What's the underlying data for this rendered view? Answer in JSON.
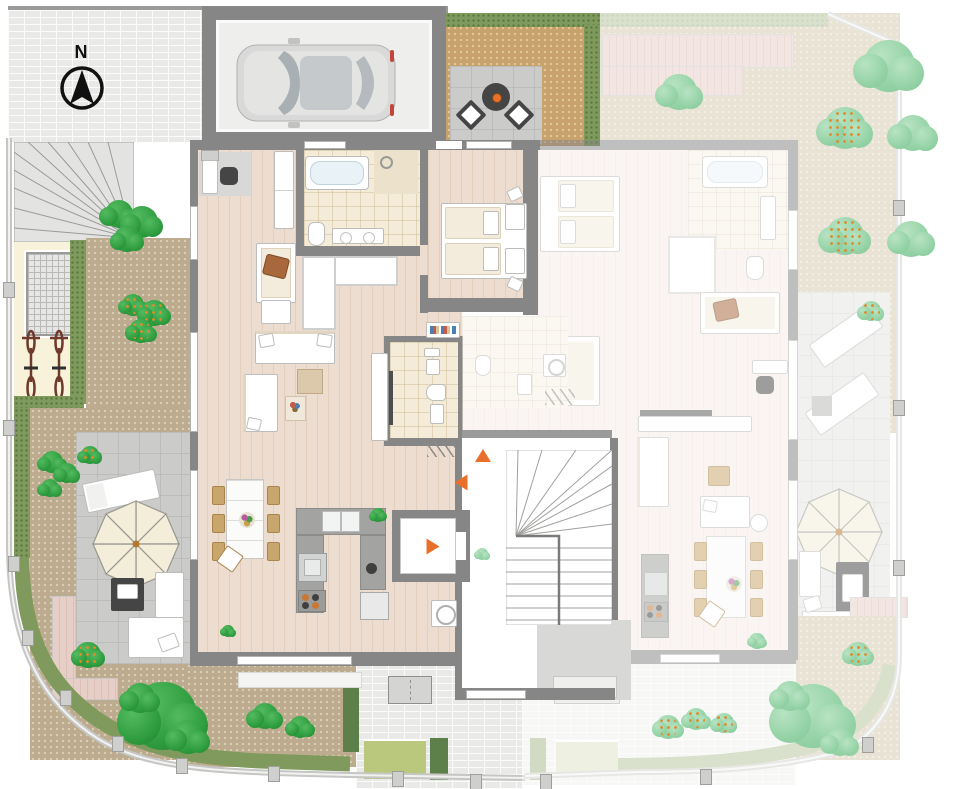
{
  "compass": {
    "label": "N"
  },
  "units": {
    "left": {
      "id": "apartment-left",
      "status": "highlighted"
    },
    "right": {
      "id": "apartment-right",
      "status": "dimmed"
    }
  },
  "palette": {
    "wall": "#868686",
    "wood": "#ecddd0",
    "wood_faded": "#f6ede7",
    "tile": "#f4ecd9",
    "terrace": "#cbcbc9",
    "brick": "#e9e9e7",
    "dirt_warm": "#c7a26c",
    "dirt_cool": "#bcab8e",
    "dirt_faded": "#d4cbb0",
    "hedge": "#7f9a5c",
    "hedge_faded": "#b7c49c",
    "lawn": "#b9c87d",
    "lawn_faded": "#e0e6c6",
    "tree": "#2f9e40",
    "tree_faded": "#95d3a6",
    "deck": "#e7cfc8",
    "umbrella": "#f3edd9",
    "accent_orange": "#e8702a",
    "car_body": "#d9d9d9"
  },
  "markers": {
    "entrance_arrows": [
      {
        "x": 483,
        "y": 456,
        "dir": "up"
      },
      {
        "x": 461,
        "y": 483,
        "dir": "left"
      },
      {
        "x": 433,
        "y": 547,
        "dir": "right"
      }
    ]
  },
  "vegetation": {
    "trees": [
      {
        "x": 119,
        "y": 214,
        "r": 17,
        "kind": "bright"
      },
      {
        "x": 142,
        "y": 222,
        "r": 19,
        "kind": "bright"
      },
      {
        "x": 127,
        "y": 239,
        "r": 15,
        "kind": "bright"
      },
      {
        "x": 133,
        "y": 305,
        "r": 13,
        "kind": "flower"
      },
      {
        "x": 154,
        "y": 313,
        "r": 15,
        "kind": "flower"
      },
      {
        "x": 141,
        "y": 331,
        "r": 14,
        "kind": "flower"
      },
      {
        "x": 52,
        "y": 462,
        "r": 13,
        "kind": "bright"
      },
      {
        "x": 67,
        "y": 473,
        "r": 12,
        "kind": "bright"
      },
      {
        "x": 50,
        "y": 488,
        "r": 11,
        "kind": "bright"
      },
      {
        "x": 90,
        "y": 455,
        "r": 11,
        "kind": "flower"
      },
      {
        "x": 88,
        "y": 655,
        "r": 15,
        "kind": "flower"
      },
      {
        "x": 163,
        "y": 716,
        "r": 40,
        "kind": "bright"
      },
      {
        "x": 140,
        "y": 698,
        "r": 18,
        "kind": "bright"
      },
      {
        "x": 188,
        "y": 737,
        "r": 20,
        "kind": "bright"
      },
      {
        "x": 265,
        "y": 716,
        "r": 16,
        "kind": "bright"
      },
      {
        "x": 300,
        "y": 727,
        "r": 13,
        "kind": "bright"
      },
      {
        "x": 228,
        "y": 631,
        "r": 7,
        "kind": "bright"
      },
      {
        "x": 378,
        "y": 515,
        "r": 8,
        "kind": "bright"
      },
      {
        "x": 679,
        "y": 92,
        "r": 21,
        "kind": "fade"
      },
      {
        "x": 889,
        "y": 66,
        "r": 31,
        "kind": "fade"
      },
      {
        "x": 845,
        "y": 128,
        "r": 25,
        "kind": "fadedflower"
      },
      {
        "x": 913,
        "y": 133,
        "r": 22,
        "kind": "fade"
      },
      {
        "x": 845,
        "y": 236,
        "r": 23,
        "kind": "fadedflower"
      },
      {
        "x": 911,
        "y": 239,
        "r": 21,
        "kind": "fade"
      },
      {
        "x": 871,
        "y": 311,
        "r": 12,
        "kind": "fadedflower"
      },
      {
        "x": 813,
        "y": 716,
        "r": 38,
        "kind": "fade"
      },
      {
        "x": 790,
        "y": 696,
        "r": 18,
        "kind": "fade"
      },
      {
        "x": 840,
        "y": 742,
        "r": 17,
        "kind": "fade"
      },
      {
        "x": 668,
        "y": 727,
        "r": 14,
        "kind": "fadedflower"
      },
      {
        "x": 696,
        "y": 719,
        "r": 13,
        "kind": "fadedflower"
      },
      {
        "x": 724,
        "y": 723,
        "r": 12,
        "kind": "fadedflower"
      },
      {
        "x": 858,
        "y": 654,
        "r": 14,
        "kind": "fadedflower"
      },
      {
        "x": 757,
        "y": 641,
        "r": 9,
        "kind": "fade"
      },
      {
        "x": 482,
        "y": 554,
        "r": 7,
        "kind": "fade"
      }
    ]
  },
  "fence_posts": [
    [
      3,
      282
    ],
    [
      3,
      420
    ],
    [
      8,
      556
    ],
    [
      22,
      630
    ],
    [
      60,
      690
    ],
    [
      112,
      736
    ],
    [
      176,
      758
    ],
    [
      268,
      766
    ],
    [
      392,
      771
    ],
    [
      470,
      774
    ],
    [
      893,
      200
    ],
    [
      893,
      400
    ],
    [
      893,
      560
    ],
    [
      862,
      737
    ],
    [
      700,
      769
    ],
    [
      540,
      774
    ]
  ]
}
